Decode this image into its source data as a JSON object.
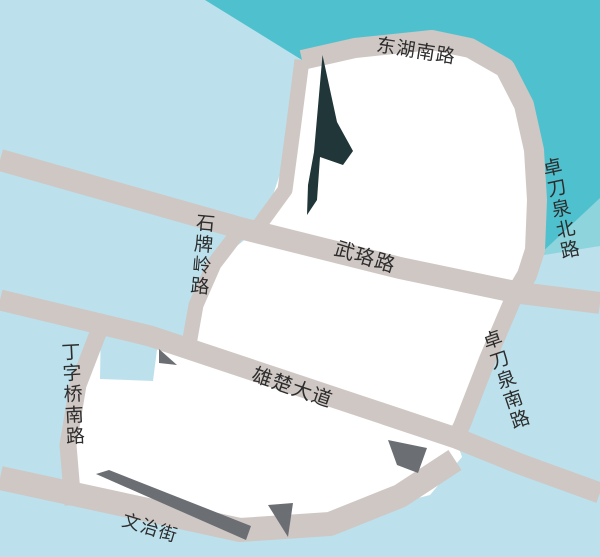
{
  "map": {
    "description": "Stylized street map with lake, city blocks and labeled roads",
    "colors": {
      "water_light": "#BCE1EC",
      "water_teal": "#4FC1CE",
      "water_teal_light": "#8ED4DC",
      "road": "#CFC7C4",
      "block": "#FFFFFF",
      "shadow": "#6B6F74",
      "landmark_dark": "#203639",
      "label_text": "#2D2D2D"
    },
    "labels": {
      "donghu_south_road": "东湖南路",
      "zhuodaoquan_north_road": "卓刀泉北路",
      "wuluo_road": "武珞路",
      "shipailing_road": "石牌岭路",
      "dingziqiao_south_road": "丁字桥南路",
      "xiongchu_avenue": "雄楚大道",
      "zhuodaoquan_south_road": "卓刀泉南路",
      "wenzhi_street": "文治街"
    }
  }
}
